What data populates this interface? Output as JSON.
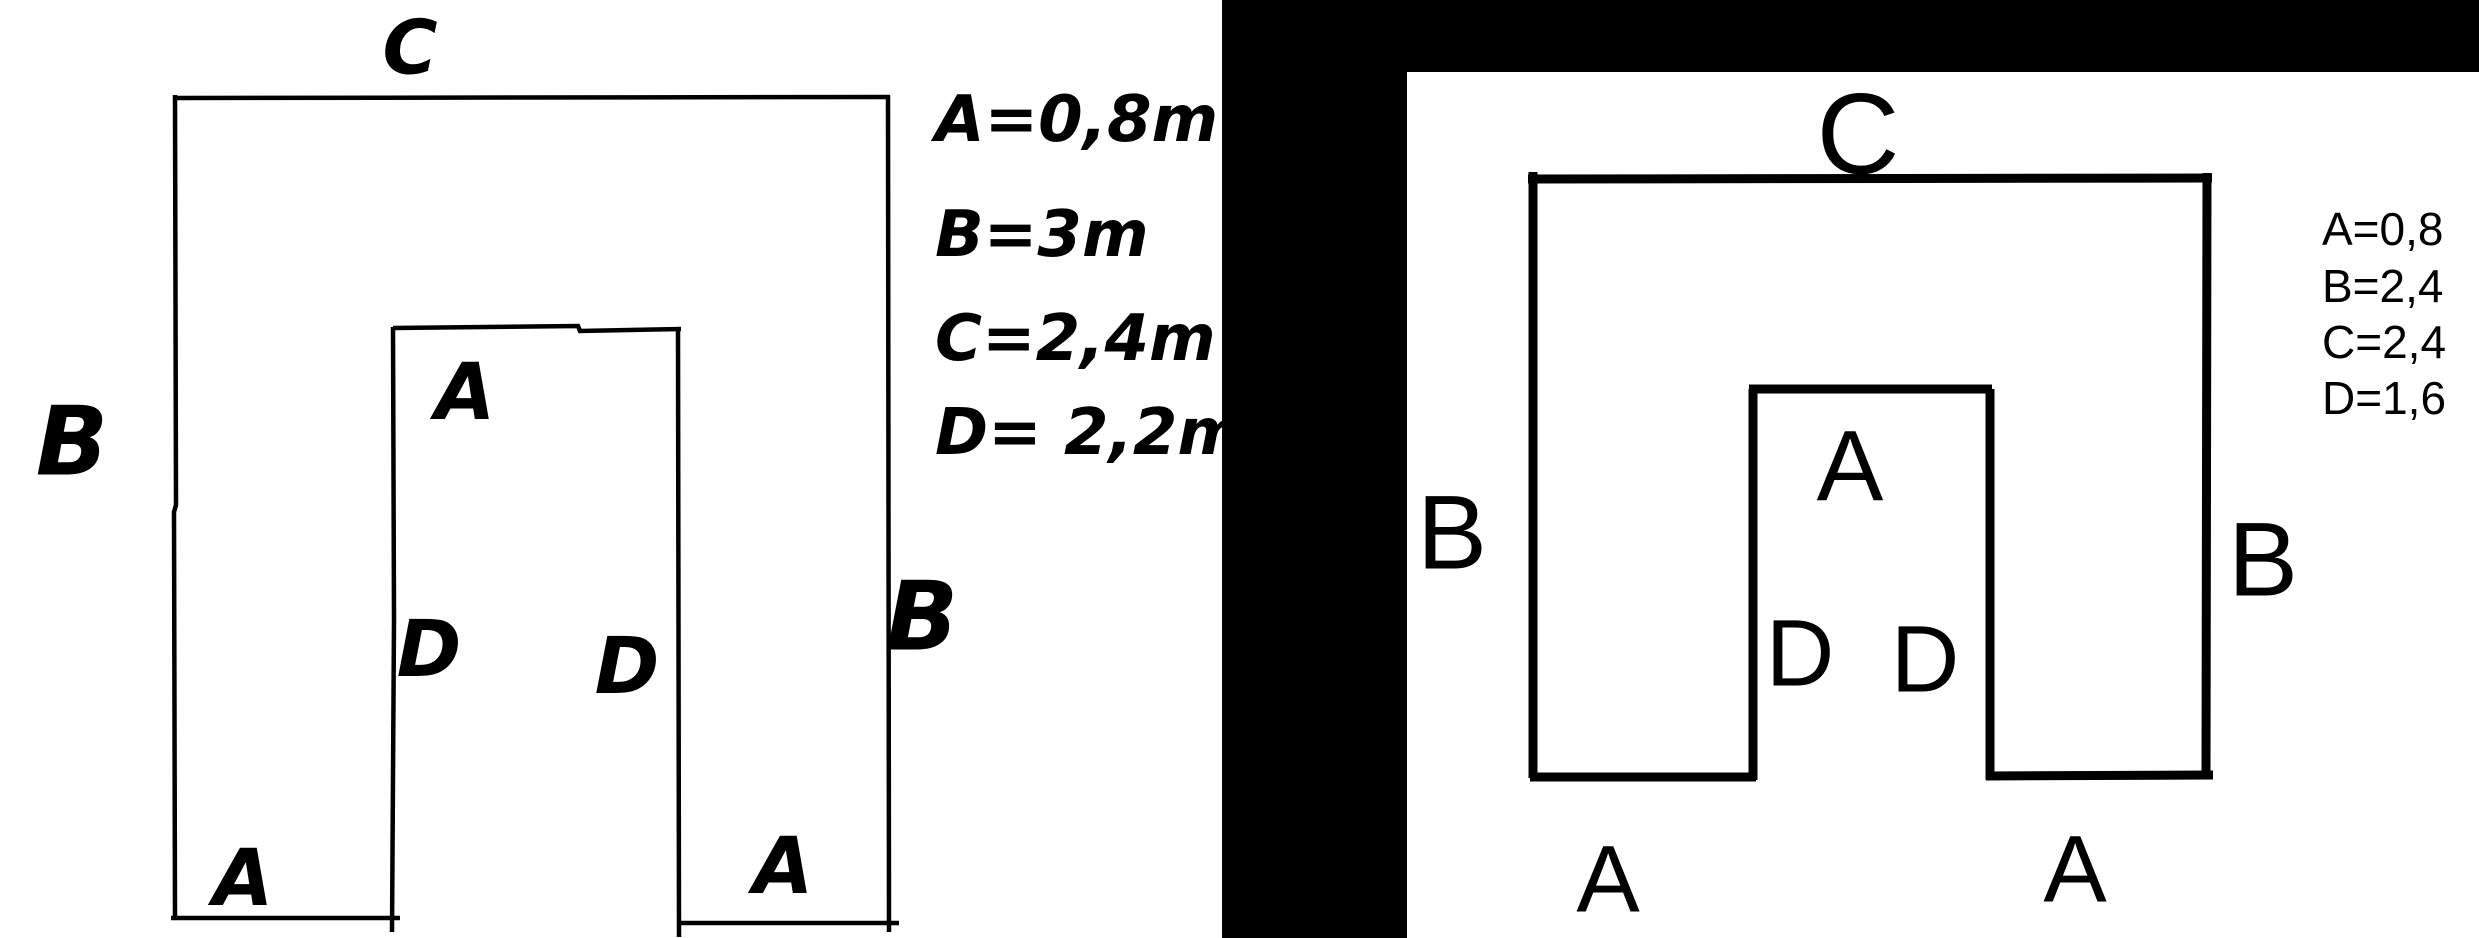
{
  "colors": {
    "ink": "#000000",
    "paper": "#ffffff",
    "mask": "#000000"
  },
  "left_figure": {
    "description": "hand-drawn U-shaped figure (square with bottom notch)",
    "labels": {
      "top_edge": "C",
      "left_edge": "B",
      "right_edge": "B",
      "notch_top": "A",
      "notch_left": "D",
      "notch_right": "D",
      "bottom_left_leg": "A",
      "bottom_right_leg": "A"
    },
    "measurements": [
      "A=0,8m",
      "B=3m",
      "C=2,4m",
      "D= 2,2m"
    ]
  },
  "right_figure": {
    "description": "clean traced U-shaped figure (square with bottom notch)",
    "labels": {
      "top_edge": "C",
      "left_edge": "B",
      "right_edge": "B",
      "notch_top": "A",
      "notch_left": "D",
      "notch_right": "D",
      "bottom_left_leg": "A",
      "bottom_right_leg": "A"
    },
    "measurements": [
      "A=0,8",
      "B=2,4",
      "C=2,4",
      "D=1,6"
    ]
  }
}
